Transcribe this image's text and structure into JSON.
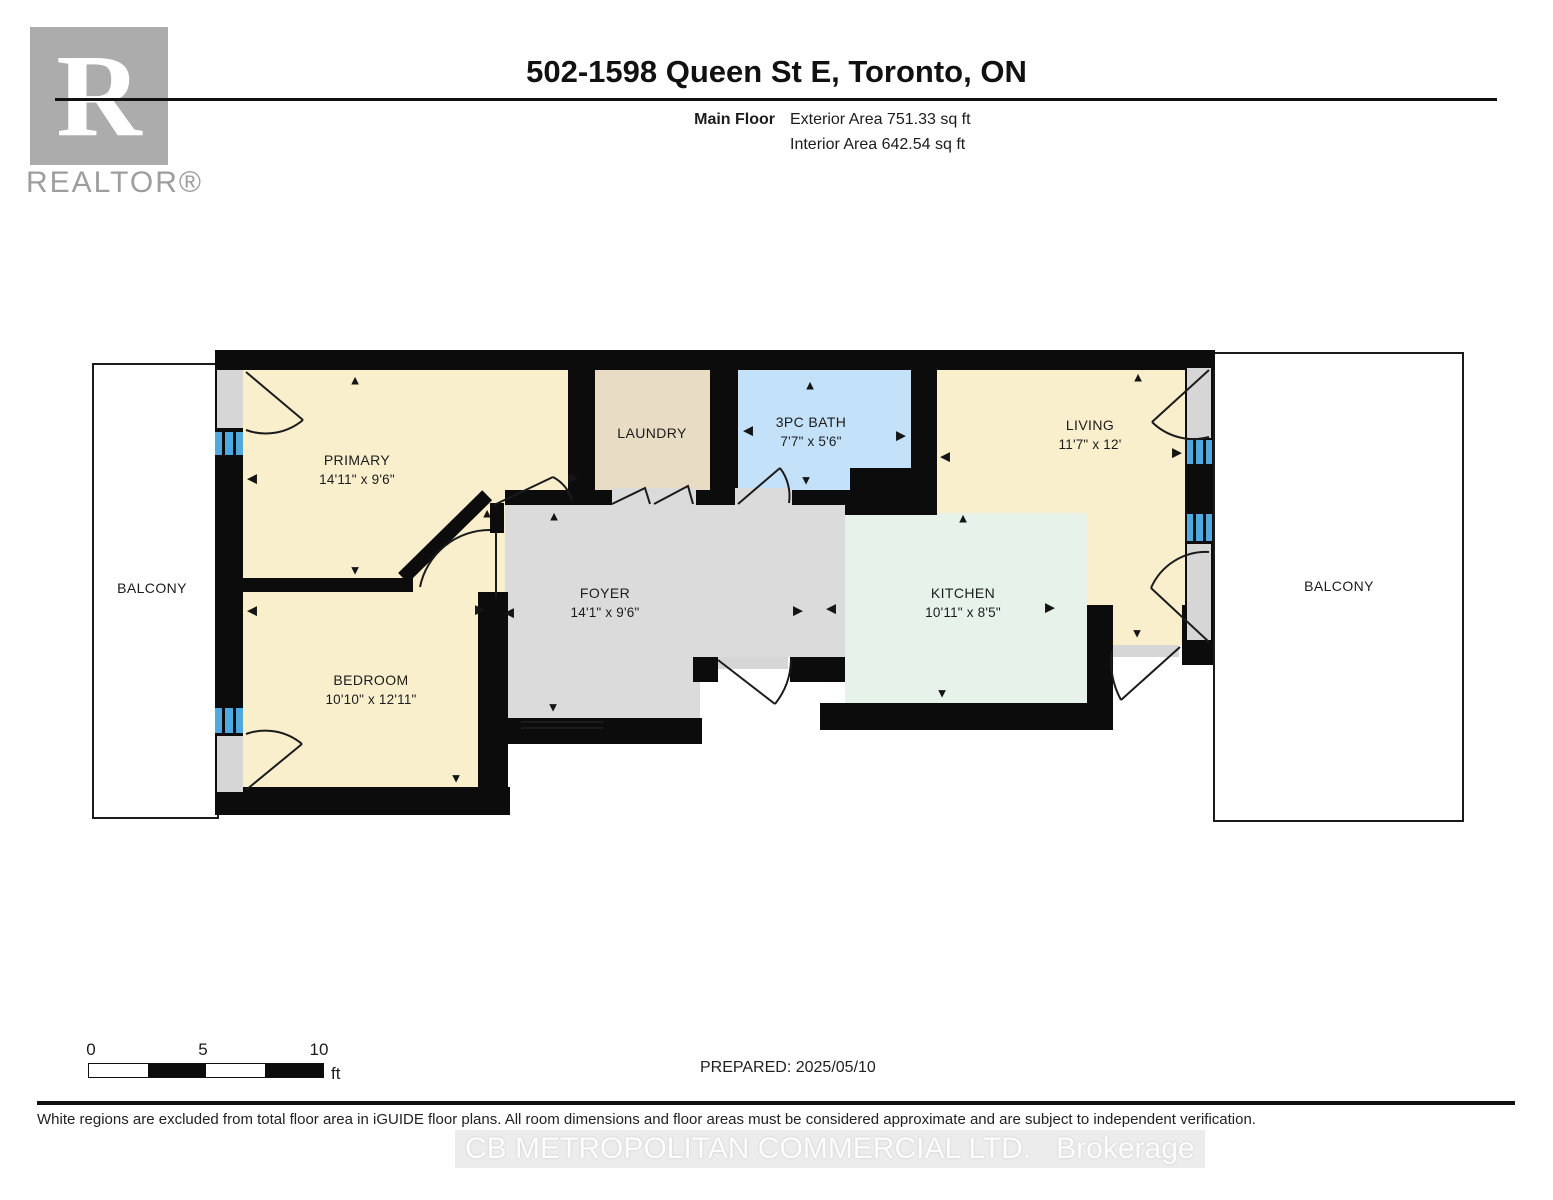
{
  "header": {
    "logo_letter": "R",
    "logo_label": "REALTOR®",
    "title": "502-1598 Queen St E, Toronto, ON",
    "floor_label": "Main Floor",
    "exterior_area": "Exterior Area 751.33 sq ft",
    "interior_area": "Interior Area 642.54 sq ft"
  },
  "rooms": {
    "primary": {
      "name": "PRIMARY",
      "dims": "14'11\" x 9'6\""
    },
    "bedroom": {
      "name": "BEDROOM",
      "dims": "10'10\" x 12'11\""
    },
    "laundry": {
      "name": "LAUNDRY",
      "dims": ""
    },
    "bath": {
      "name": "3PC BATH",
      "dims": "7'7\" x 5'6\""
    },
    "living": {
      "name": "LIVING",
      "dims": "11'7\" x 12'"
    },
    "kitchen": {
      "name": "KITCHEN",
      "dims": "10'11\" x 8'5\""
    },
    "foyer": {
      "name": "FOYER",
      "dims": "14'1\" x 9'6\""
    },
    "balcony_left": {
      "name": "BALCONY"
    },
    "balcony_right": {
      "name": "BALCONY"
    }
  },
  "colors": {
    "wall": "#0c0c0c",
    "room_cream": "#f9efcc",
    "room_tan": "#e9dcc5",
    "room_blue": "#c3e2fa",
    "room_mint": "#e6f2ea",
    "room_grey": "#dbdbdb",
    "window_blue": "#4fa9df",
    "door_grey": "#d6d6d6",
    "logo_grey": "#acacac"
  },
  "icons": {
    "camera_arrow_up": "▲",
    "camera_arrow_down": "▼",
    "camera_arrow_left": "◀",
    "camera_arrow_right": "▶"
  },
  "floorplan": {
    "arrows": [
      {
        "x": 355,
        "y": 380,
        "dir": "up"
      },
      {
        "x": 252,
        "y": 478,
        "dir": "left"
      },
      {
        "x": 355,
        "y": 570,
        "dir": "down"
      },
      {
        "x": 252,
        "y": 610,
        "dir": "left"
      },
      {
        "x": 480,
        "y": 609,
        "dir": "right"
      },
      {
        "x": 509,
        "y": 612,
        "dir": "left"
      },
      {
        "x": 456,
        "y": 778,
        "dir": "down"
      },
      {
        "x": 573,
        "y": 477,
        "dir": "right"
      },
      {
        "x": 487,
        "y": 513,
        "dir": "up"
      },
      {
        "x": 810,
        "y": 385,
        "dir": "up"
      },
      {
        "x": 748,
        "y": 430,
        "dir": "left"
      },
      {
        "x": 901,
        "y": 435,
        "dir": "right"
      },
      {
        "x": 806,
        "y": 480,
        "dir": "down"
      },
      {
        "x": 945,
        "y": 456,
        "dir": "left"
      },
      {
        "x": 1138,
        "y": 377,
        "dir": "up"
      },
      {
        "x": 1177,
        "y": 452,
        "dir": "right"
      },
      {
        "x": 1137,
        "y": 633,
        "dir": "down"
      },
      {
        "x": 963,
        "y": 518,
        "dir": "up"
      },
      {
        "x": 942,
        "y": 693,
        "dir": "down"
      },
      {
        "x": 798,
        "y": 610,
        "dir": "right"
      },
      {
        "x": 831,
        "y": 608,
        "dir": "left"
      },
      {
        "x": 554,
        "y": 516,
        "dir": "up"
      },
      {
        "x": 553,
        "y": 707,
        "dir": "down"
      },
      {
        "x": 1050,
        "y": 607,
        "dir": "right"
      }
    ]
  },
  "scale_bar": {
    "tick0": "0",
    "tick5": "5",
    "tick10": "10",
    "unit": "ft"
  },
  "footer": {
    "prepared": "PREPARED: 2025/05/10",
    "disclaimer": "White regions are excluded from total floor area in iGUIDE floor plans. All room dimensions and floor areas must be considered approximate and are subject to independent verification.",
    "watermark": "CB METROPOLITAN COMMERCIAL LTD.   Brokerage"
  }
}
